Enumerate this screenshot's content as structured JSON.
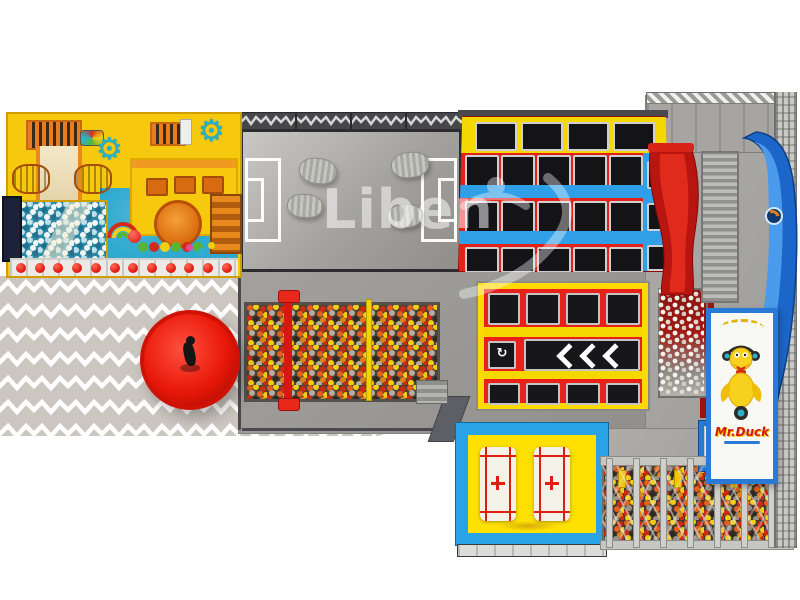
{
  "canvas": {
    "width": 800,
    "height": 600,
    "background": "#ffffff"
  },
  "branding": {
    "court_watermark": "Liben",
    "banner_title": "Mr.Duck",
    "pit_sign_title": "Mr.Duck"
  },
  "icons": {
    "gear": "⚙",
    "spin_glyph": "↻",
    "lane_chevrons_icon": "triple-left-chevron",
    "duck_mascot_icon": "duck-with-headphones",
    "jumper_watermark_icon": "liben-jumping-figure"
  },
  "colors": {
    "floor_gray": "#989793",
    "zigzag_base": "#ccc6c0",
    "zigzag_stripe": "#ffffff",
    "frame_yellow": "#f6c80e",
    "tramp_red": "#e32119",
    "tramp_yellow": "#ffd900",
    "tramp_mat_black": "#17171a",
    "stripe_blue": "#2f9fe8",
    "slide_blue": "#1b66c8",
    "slide_red": "#c41a10",
    "kids_floor_blue": "#2fa9d0",
    "spinner_red": "#e81808",
    "banner_blue": "#2979d6",
    "duck_yellow": "#f7d11e",
    "ball_orange": "#e4601c",
    "ball_yellow": "#f2cd15",
    "ball_red": "#cd2a14",
    "ball_gray": "#b6ada0"
  }
}
